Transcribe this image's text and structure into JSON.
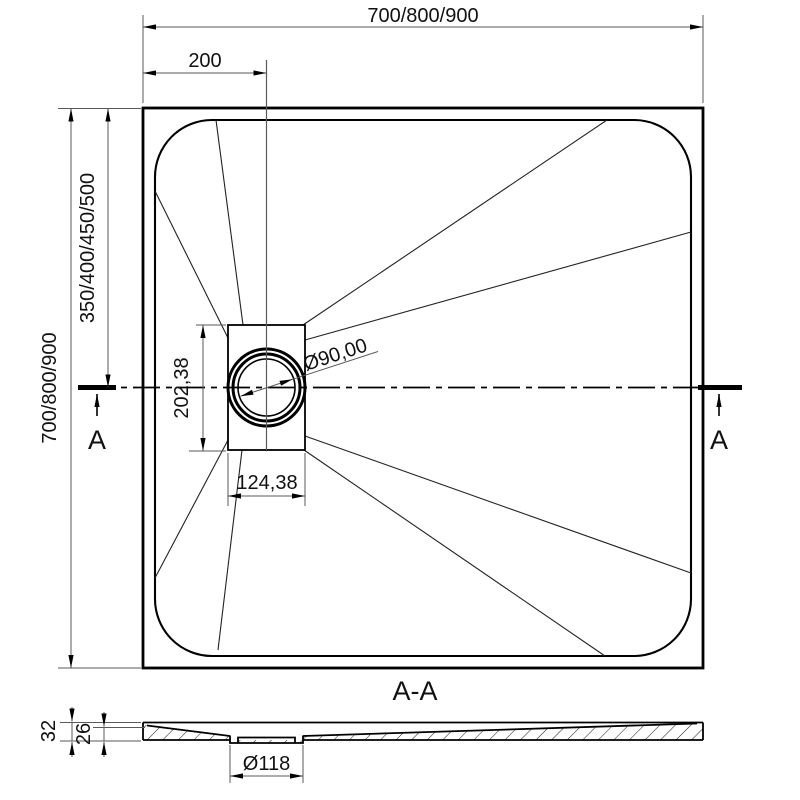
{
  "plan_view": {
    "top_width_dim": "700/800/900",
    "drain_offset_dim": "200",
    "left_height_dim": "700/800/900",
    "left_half_height_dim": "350/400/450/500",
    "drain_box_height_dim": "202,38",
    "drain_box_width_dim": "124,38",
    "drain_diameter_dim": "Ø90,00",
    "section_cut_label_left": "A",
    "section_cut_label_right": "A"
  },
  "section_view": {
    "title": "A-A",
    "edge_thickness_dim": "32",
    "floor_thickness_dim": "26",
    "drain_hole_diameter_dim": "Ø118"
  },
  "colors": {
    "line": "#000000",
    "construction": "#595959",
    "text": "#111111",
    "background": "#ffffff"
  }
}
